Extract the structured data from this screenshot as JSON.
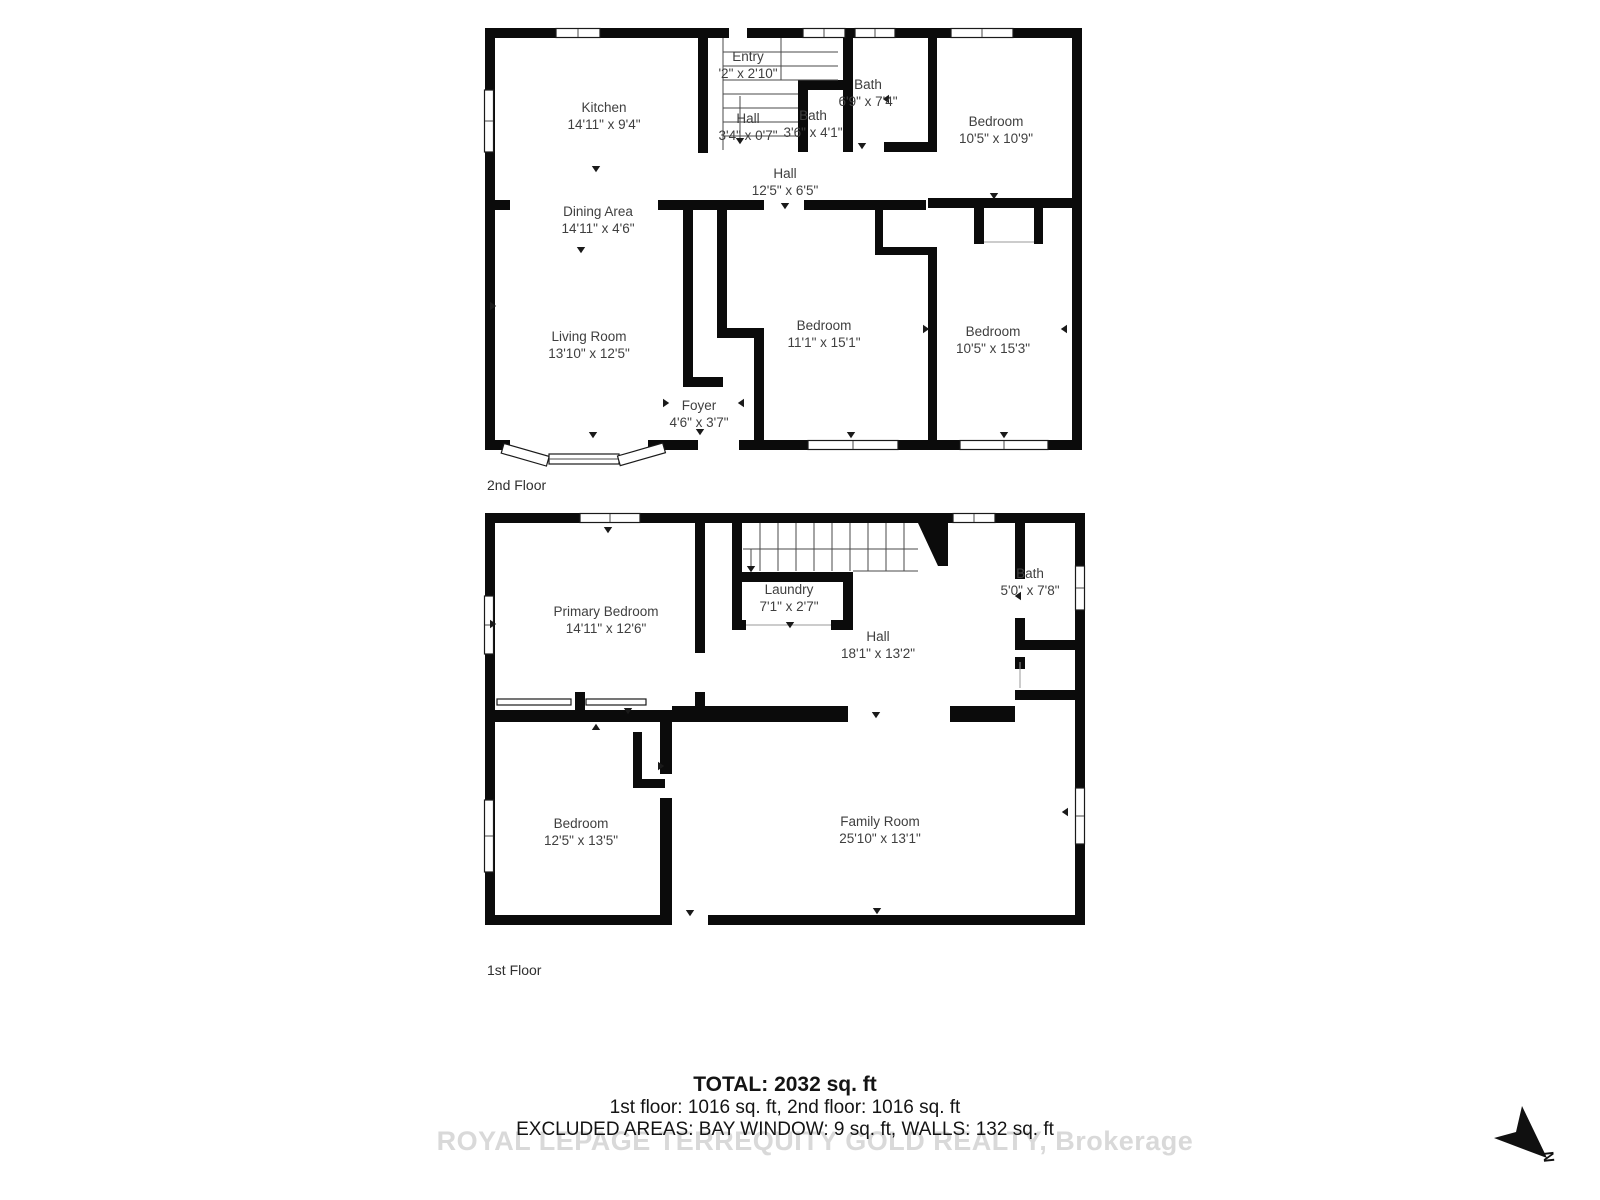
{
  "floors": [
    {
      "label": "2nd Floor",
      "rooms": [
        {
          "name": "Kitchen",
          "dims": "14'11\" x 9'4\""
        },
        {
          "name": "Entry",
          "dims": "'2\" x 2'10\""
        },
        {
          "name": "Bath",
          "dims": "6'9\" x 7'4\""
        },
        {
          "name": "Bath",
          "dims": "3'6\" x 4'1\""
        },
        {
          "name": "Bedroom",
          "dims": "10'5\" x 10'9\""
        },
        {
          "name": "Hall",
          "dims": "3'4\" x 0'7\""
        },
        {
          "name": "Hall",
          "dims": "12'5\" x 6'5\""
        },
        {
          "name": "Dining Area",
          "dims": "14'11\" x 4'6\""
        },
        {
          "name": "Living Room",
          "dims": "13'10\" x 12'5\""
        },
        {
          "name": "Bedroom",
          "dims": "11'1\" x 15'1\""
        },
        {
          "name": "Bedroom",
          "dims": "10'5\" x 15'3\""
        },
        {
          "name": "Foyer",
          "dims": "4'6\" x 3'7\""
        }
      ]
    },
    {
      "label": "1st Floor",
      "rooms": [
        {
          "name": "Primary Bedroom",
          "dims": "14'11\" x 12'6\""
        },
        {
          "name": "Laundry",
          "dims": "7'1\" x 2'7\""
        },
        {
          "name": "Hall",
          "dims": "18'1\" x 13'2\""
        },
        {
          "name": "Bath",
          "dims": "5'0\" x 7'8\""
        },
        {
          "name": "Bedroom",
          "dims": "12'5\" x 13'5\""
        },
        {
          "name": "Family Room",
          "dims": "25'10\" x 13'1\""
        }
      ]
    }
  ],
  "summary": {
    "total": "TOTAL: 2032 sq. ft",
    "floors_breakdown": "1st floor: 1016 sq. ft, 2nd floor: 1016 sq. ft",
    "excluded": "EXCLUDED AREAS: BAY WINDOW: 9 sq. ft, WALLS: 132 sq. ft"
  },
  "watermark": "ROYAL LEPAGE TERREQUITY GOLD REALTY, Brokerage",
  "compass": {
    "label": "N"
  }
}
